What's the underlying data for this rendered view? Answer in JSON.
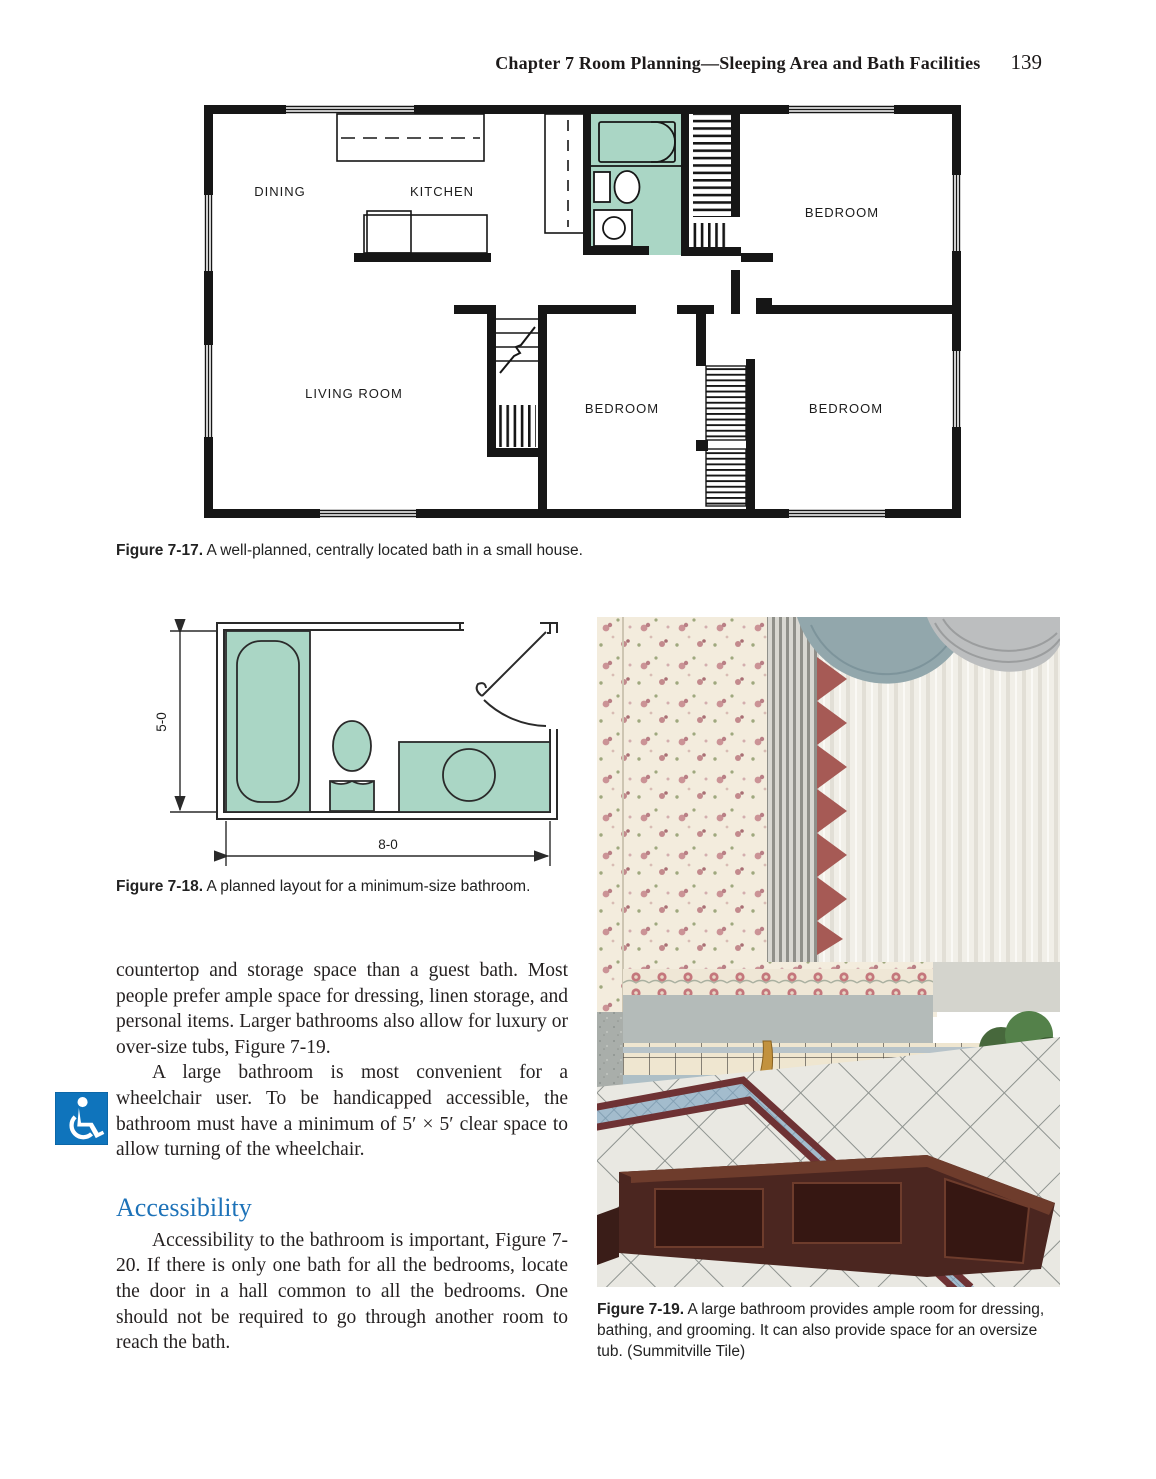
{
  "header": {
    "chapter_and_title": "Chapter 7    Room Planning—Sleeping Area and Bath Facilities",
    "page_number": "139"
  },
  "figure_7_17": {
    "caption_label": "Figure 7-17.",
    "caption_text": " A well-planned, centrally located bath in a small house.",
    "room_labels": {
      "dining": "DINING",
      "kitchen": "KITCHEN",
      "bedroom_top_right": "BEDROOM",
      "living_room": "LIVING ROOM",
      "bedroom_bottom_middle": "BEDROOM",
      "bedroom_bottom_right": "BEDROOM"
    }
  },
  "figure_7_18": {
    "caption_label": "Figure 7-18.",
    "caption_text": " A planned layout for a minimum-size bathroom.",
    "dimensions": {
      "height": "5-0",
      "width": "8-0"
    }
  },
  "figure_7_19": {
    "caption_label": "Figure 7-19.",
    "caption_text": " A large bathroom provides ample room for dressing, bathing, and grooming. It can also provide space for an oversize tub. (Summitville Tile)"
  },
  "body": {
    "paragraph_1": "countertop and storage space than a guest bath. Most people prefer ample space for dressing, linen storage, and personal items. Larger bathrooms also allow for luxury or over-size tubs, Figure 7-19.",
    "paragraph_2": "A large bathroom is most convenient for a wheelchair user. To be handicapped accessible, the bathroom must have a minimum of 5′ × 5′ clear space to allow turning of the wheelchair.",
    "accessibility_heading": "Accessibility",
    "paragraph_3": "Accessibility to the bathroom is important, Figure 7-20. If there is only one bath for all the bedrooms, locate the door in a hall common to all the bedrooms. One should not be required to go through another room to reach the bath."
  },
  "colors": {
    "plan_teal": "#aad6c5",
    "heading_blue": "#1d72b8",
    "icon_blue": "#0f74bc",
    "wall_black": "#161616"
  }
}
